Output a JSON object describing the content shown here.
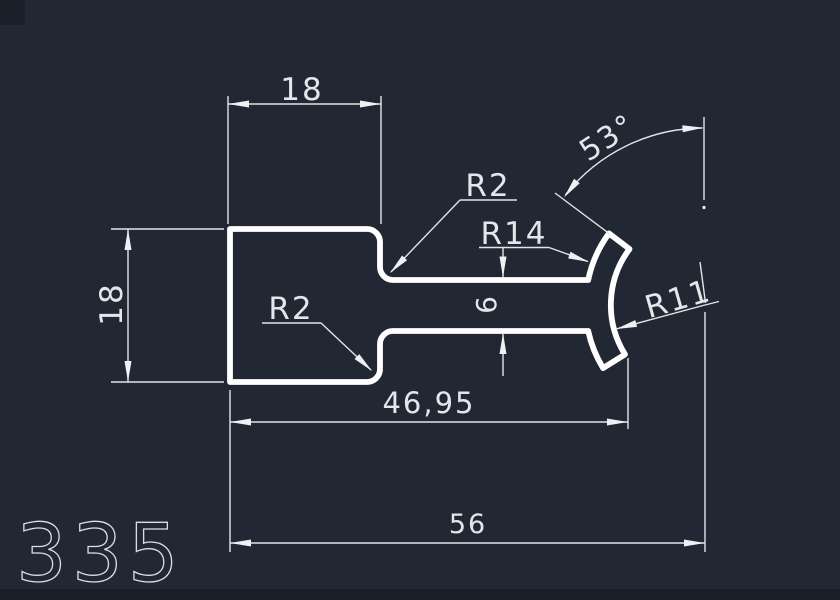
{
  "drawing": {
    "number": "335",
    "background_color": "#212833",
    "profile_color": "#ffffff",
    "dimension_color": "#e2e7eb",
    "dimensions": {
      "top_width": "18",
      "left_height": "18",
      "neck_height": "6",
      "body_length": "46,95",
      "total_length": "56",
      "top_fillet_radius": "R2",
      "bottom_fillet_radius": "R2",
      "flange_outer_radius": "R14",
      "flange_inner_radius": "R11",
      "flange_angle": "53°"
    }
  }
}
